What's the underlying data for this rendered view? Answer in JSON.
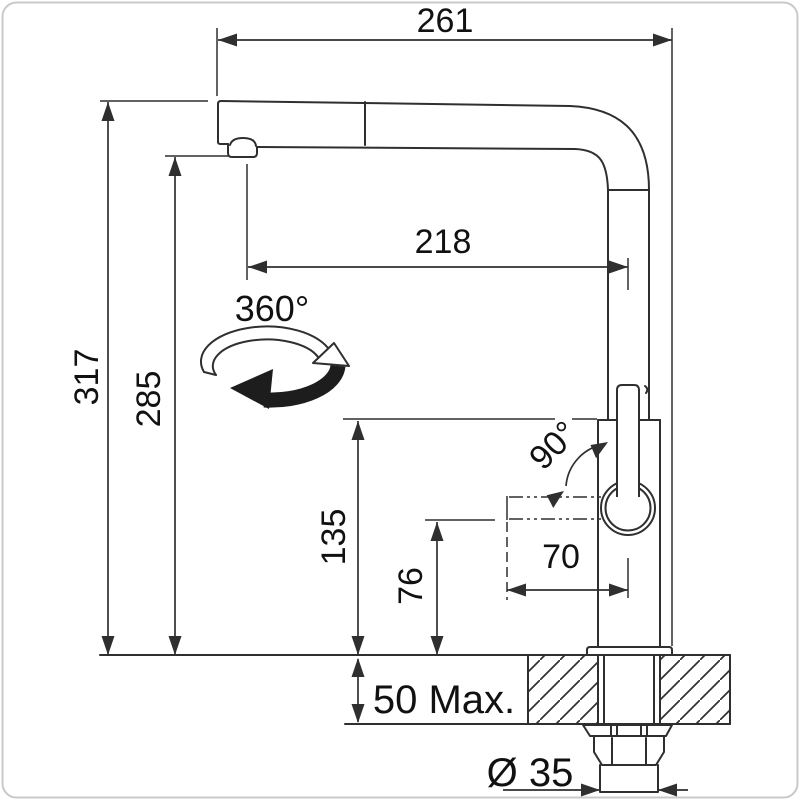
{
  "drawing": {
    "subject": "kitchen-faucet-dimension-drawing",
    "dimensions": {
      "overall_width": "261",
      "spout_reach": "218",
      "overall_height": "317",
      "aerator_height": "285",
      "body_height": "135",
      "handle_axis_height": "76",
      "handle_reach": "70",
      "counter_thickness": "50 Max.",
      "hole_diameter": "Ø 35"
    },
    "annotations": {
      "swivel_angle": "360°",
      "handle_swing_angle": "90°"
    },
    "colors": {
      "line": "#2f2f2f",
      "text": "#111111",
      "background": "#ffffff",
      "card_border": "#c9c9c9"
    }
  }
}
